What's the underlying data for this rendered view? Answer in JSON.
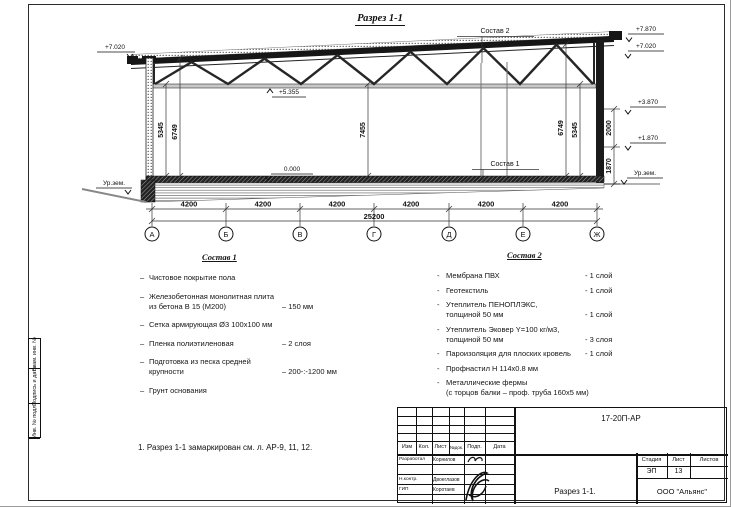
{
  "sheet": {
    "title": "Разрез 1-1",
    "note": "1. Разрез 1-1 замаркирован см. л. АР-9, 11, 12."
  },
  "drawing": {
    "axes": [
      "А",
      "Б",
      "В",
      "Г",
      "Д",
      "Е",
      "Ж"
    ],
    "bay_dims": [
      "4200",
      "4200",
      "4200",
      "4200",
      "4200",
      "4200"
    ],
    "total_dim": "25200",
    "dims": {
      "left_h1": "5345",
      "left_h2": "6749",
      "mid_h": "7455",
      "right_h2": "6749",
      "right_h1": "5345",
      "wall_upper": "2000",
      "wall_lower": "1870"
    },
    "elevations": {
      "left_eave": "+7.020",
      "ridge": "+7.870",
      "right_eave": "+7.020",
      "right_mid": "+3.870",
      "right_low": "+1.870",
      "floor": "0.000",
      "truss_bottom": "+5.355",
      "ground_left": "Ур.зем.",
      "ground_right": "Ур.зем."
    },
    "refs": {
      "sostav1": "Состав 1",
      "sostav2": "Состав 2"
    }
  },
  "sostav1": {
    "title": "Состав 1",
    "dash": "–",
    "items": [
      {
        "text": "Чистовое покрытие пола",
        "value": ""
      },
      {
        "text": "Железобетонная  монолитная плита\nиз бетона В 15 (М200)",
        "value": "– 150 мм"
      },
      {
        "text": "Сетка армирующая Ø3 100х100 мм",
        "value": ""
      },
      {
        "text": "Пленка полиэтиленовая",
        "value": "– 2 слоя"
      },
      {
        "text": "Подготовка из песка средней\nкрупности",
        "value": "– 200-:-1200 мм"
      },
      {
        "text": "Грунт основания",
        "value": ""
      }
    ]
  },
  "sostav2": {
    "title": "Состав 2",
    "dash": "-",
    "items": [
      {
        "text": "Мембрана ПВХ",
        "value": "- 1 слой"
      },
      {
        "text": "Геотекстиль",
        "value": "- 1 слой"
      },
      {
        "text": "Утеплитель ПЕНОПЛЭКС,\nтолщиной 50 мм",
        "value": "- 1 слой"
      },
      {
        "text": "Утеплитель Эковер Y=100 кг/м3,\nтолщиной 50 мм",
        "value": "- 3 слоя"
      },
      {
        "text": "Пароизоляция для плоских кровель",
        "value": "- 1 слой"
      },
      {
        "text": "Профнастил Н 114х0.8 мм",
        "value": ""
      },
      {
        "text": "Металлические фермы\n(с торцов балки – проф. труба 160х5 мм)",
        "value": ""
      }
    ]
  },
  "titleblock": {
    "doc_code": "17-20П-АР",
    "header_cols": [
      "Изм",
      "Кол.",
      "Лист",
      "№док.",
      "Подп.",
      "Дата"
    ],
    "roles": [
      "Разработал",
      "Н.контр.",
      "ГИП"
    ],
    "names": [
      "Корнилов",
      "Двоеглазов",
      "Коротаев"
    ],
    "stage_label": "Стадия",
    "sheet_label": "Лист",
    "sheets_label": "Листов",
    "stage": "ЭП",
    "sheet_no": "13",
    "sheets_total": "",
    "drawing_name": "Разрез 1-1.",
    "company": "ООО \"Альянс\""
  },
  "side_strip": {
    "labels": [
      "Взам. инв. №",
      "Подпись и дата",
      "Инв. № подл."
    ]
  }
}
